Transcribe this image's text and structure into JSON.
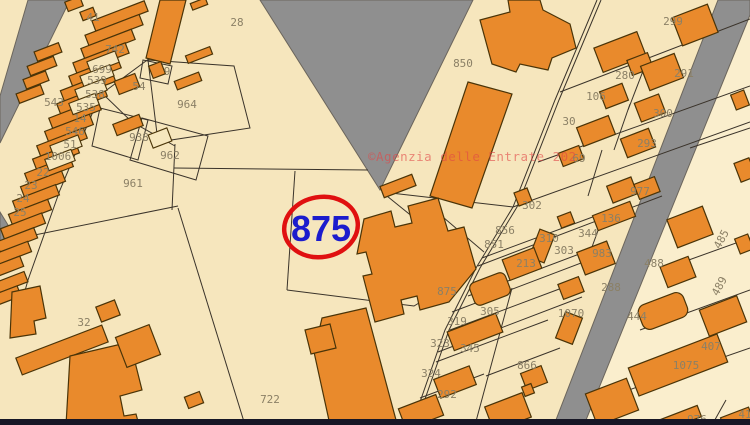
{
  "map": {
    "selected_parcel": "875",
    "copyright": "©Agenzia delle Entrate 202",
    "colors": {
      "parcel_cream": "#f6e6bd",
      "parcel_cream_light": "#faeecd",
      "building_orange": "#e98a2c",
      "building_outline": "#4a3408",
      "road_gray": "#8f8f8f",
      "boundary_line": "#3a332a",
      "label_gray": "#8b8066",
      "highlight_blue": "#1c1ccd",
      "highlight_red": "#e01010",
      "watermark_red": "#e14646",
      "bottom_bar": "#171726"
    },
    "labels": [
      {
        "t": "28",
        "x": 237,
        "y": 22
      },
      {
        "t": "41",
        "x": 93,
        "y": 17
      },
      {
        "t": "742",
        "x": 115,
        "y": 49
      },
      {
        "t": "699",
        "x": 102,
        "y": 69
      },
      {
        "t": "539",
        "x": 97,
        "y": 80
      },
      {
        "t": "538",
        "x": 95,
        "y": 94
      },
      {
        "t": "543",
        "x": 54,
        "y": 102
      },
      {
        "t": "535",
        "x": 86,
        "y": 107
      },
      {
        "t": "14",
        "x": 80,
        "y": 118
      },
      {
        "t": "546",
        "x": 75,
        "y": 131
      },
      {
        "t": "51",
        "x": 70,
        "y": 144
      },
      {
        "t": "1006",
        "x": 58,
        "y": 156
      },
      {
        "t": "22",
        "x": 43,
        "y": 172
      },
      {
        "t": "23",
        "x": 31,
        "y": 185
      },
      {
        "t": "24",
        "x": 23,
        "y": 198
      },
      {
        "t": "25",
        "x": 20,
        "y": 212
      },
      {
        "t": "9",
        "x": 167,
        "y": 71
      },
      {
        "t": "54",
        "x": 139,
        "y": 86
      },
      {
        "t": "964",
        "x": 187,
        "y": 104
      },
      {
        "t": "938",
        "x": 139,
        "y": 137
      },
      {
        "t": "962",
        "x": 170,
        "y": 155
      },
      {
        "t": "961",
        "x": 133,
        "y": 183
      },
      {
        "t": "32",
        "x": 84,
        "y": 322
      },
      {
        "t": "722",
        "x": 270,
        "y": 399
      },
      {
        "t": "850",
        "x": 463,
        "y": 63
      },
      {
        "t": "299",
        "x": 673,
        "y": 21
      },
      {
        "t": "280",
        "x": 625,
        "y": 75
      },
      {
        "t": "291",
        "x": 684,
        "y": 73
      },
      {
        "t": "106",
        "x": 596,
        "y": 96
      },
      {
        "t": "300",
        "x": 663,
        "y": 113
      },
      {
        "t": "30",
        "x": 569,
        "y": 121
      },
      {
        "t": "293",
        "x": 647,
        "y": 143
      },
      {
        "t": "69",
        "x": 579,
        "y": 158
      },
      {
        "t": "977",
        "x": 640,
        "y": 191
      },
      {
        "t": "136",
        "x": 611,
        "y": 218
      },
      {
        "t": "344",
        "x": 588,
        "y": 233
      },
      {
        "t": "302",
        "x": 532,
        "y": 205
      },
      {
        "t": "856",
        "x": 505,
        "y": 230
      },
      {
        "t": "851",
        "x": 494,
        "y": 244
      },
      {
        "t": "310",
        "x": 549,
        "y": 238
      },
      {
        "t": "213",
        "x": 526,
        "y": 263
      },
      {
        "t": "303",
        "x": 564,
        "y": 250
      },
      {
        "t": "983",
        "x": 602,
        "y": 253
      },
      {
        "t": "488",
        "x": 654,
        "y": 263
      },
      {
        "t": "288",
        "x": 611,
        "y": 287
      },
      {
        "t": "485",
        "x": 721,
        "y": 239,
        "r": -62
      },
      {
        "t": "489",
        "x": 719,
        "y": 286,
        "r": -62
      },
      {
        "t": "407",
        "x": 711,
        "y": 346
      },
      {
        "t": "444",
        "x": 637,
        "y": 316
      },
      {
        "t": "1070",
        "x": 571,
        "y": 313
      },
      {
        "t": "1075",
        "x": 686,
        "y": 365
      },
      {
        "t": "976",
        "x": 697,
        "y": 419
      },
      {
        "t": "41",
        "x": 745,
        "y": 414
      },
      {
        "t": "875",
        "x": 447,
        "y": 291
      },
      {
        "t": "305",
        "x": 490,
        "y": 311
      },
      {
        "t": "319",
        "x": 457,
        "y": 321
      },
      {
        "t": "323",
        "x": 440,
        "y": 343
      },
      {
        "t": "345",
        "x": 470,
        "y": 348
      },
      {
        "t": "324",
        "x": 431,
        "y": 373
      },
      {
        "t": "292",
        "x": 447,
        "y": 394
      },
      {
        "t": "866",
        "x": 527,
        "y": 365
      }
    ]
  }
}
